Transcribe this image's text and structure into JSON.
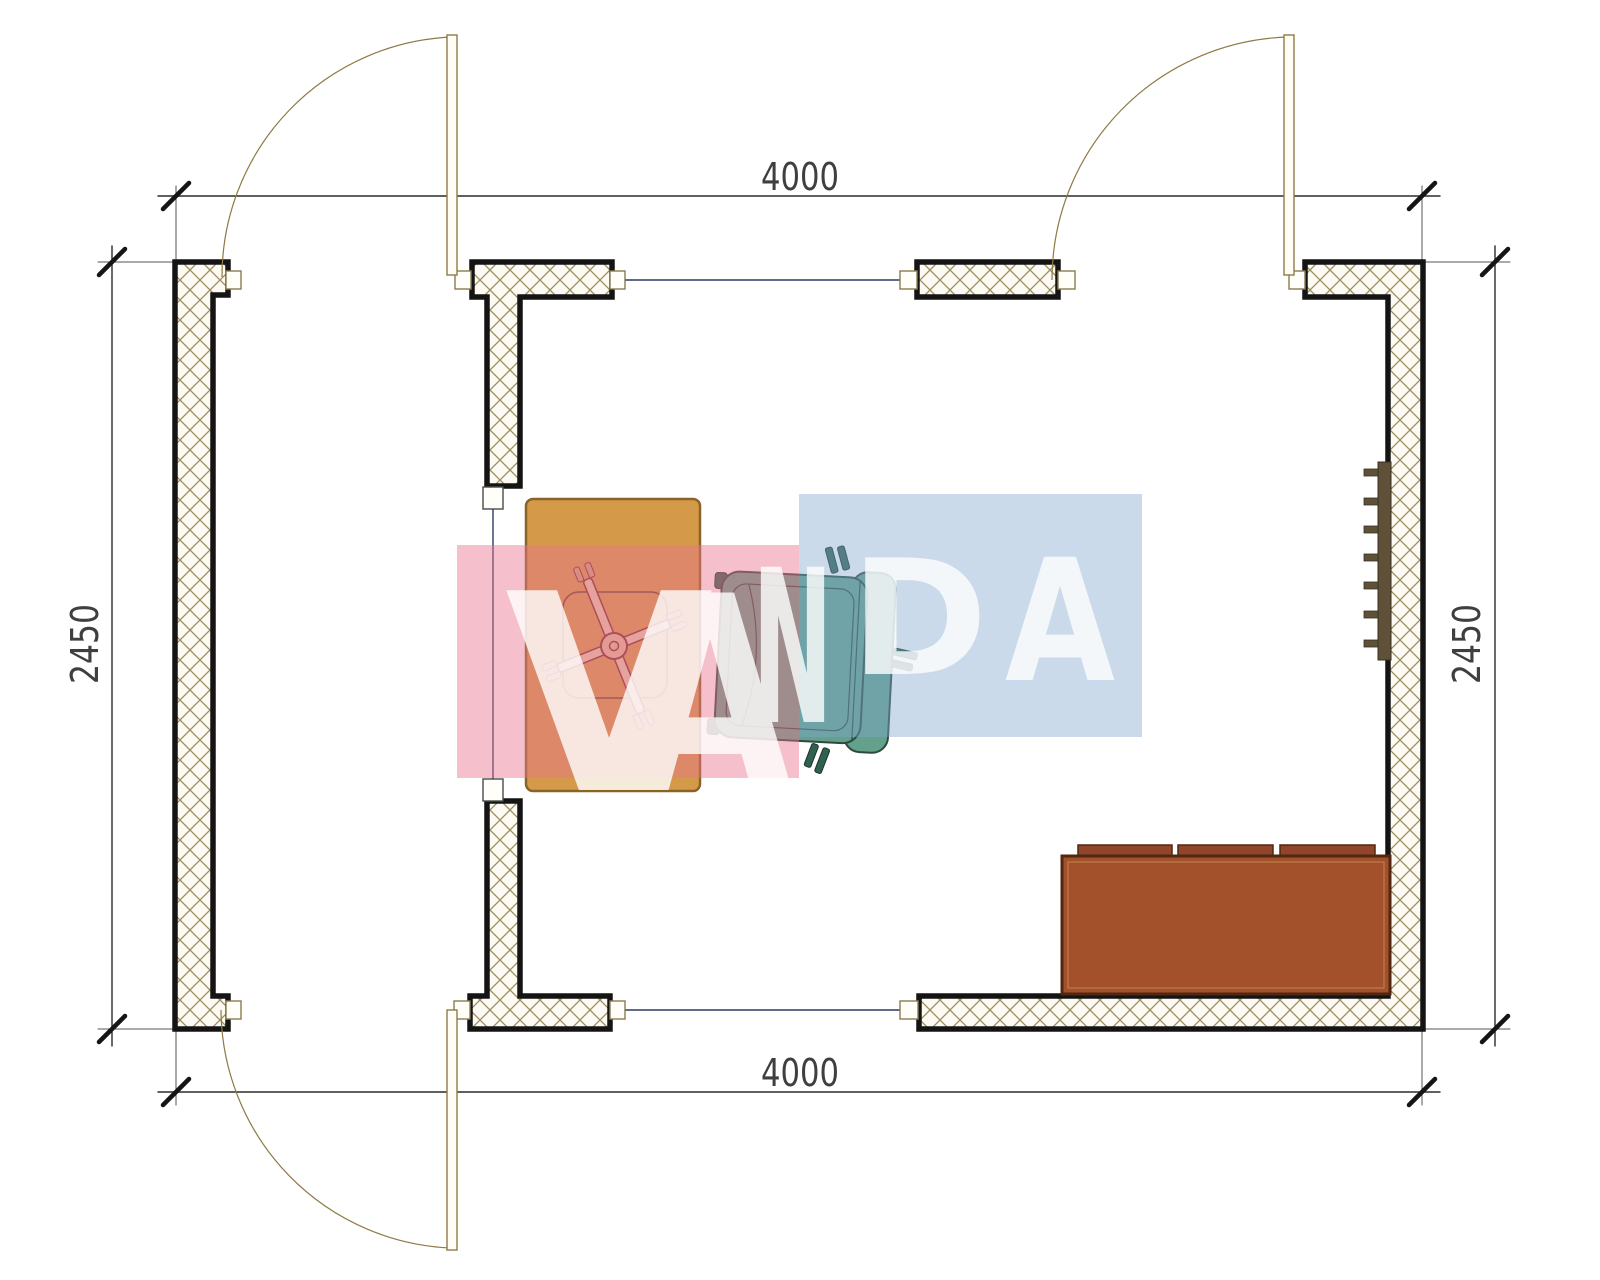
{
  "drawing": {
    "type": "architectural floor plan, top view",
    "room_width_label": "4000",
    "room_depth_label": "2450"
  },
  "dimensions": {
    "top_label": "4000",
    "bottom_label": "4000",
    "left_label": "2450",
    "right_label": "2450"
  },
  "watermark": {
    "text": "VANDA",
    "letters": [
      "V",
      "A",
      "N",
      "D",
      "A"
    ],
    "pink_block_color": "#e9738f",
    "blue_block_color": "#84a6ce",
    "letter_color": "#ffffff"
  },
  "walls": {
    "door_count": 3,
    "hatch_color": "#9c8d60",
    "outline_color": "#141414",
    "fill_color": "#fcfaf2"
  },
  "colors": {
    "door_line": "#8f7a45",
    "opening_line": "#2b3a66",
    "dimension_line": "#2b2b2b",
    "dimension_text": "#3f3f3f",
    "desk": "#d49a4a",
    "desk_border": "#8a6426",
    "office_chair_base": "#7c3030",
    "office_chair_bar_fill": "#e3c9a8",
    "armchair": "#63a18c",
    "armchair_outline": "#2e4a40",
    "armchair_feet": "#2f6152",
    "sofa": "#a3512a",
    "sofa_cushion": "#91452a",
    "sofa_border": "#512711",
    "shelf": "#5e5138"
  },
  "furniture": {
    "sofa_cushion_count": 3,
    "shelf_bracket_count": 7
  }
}
